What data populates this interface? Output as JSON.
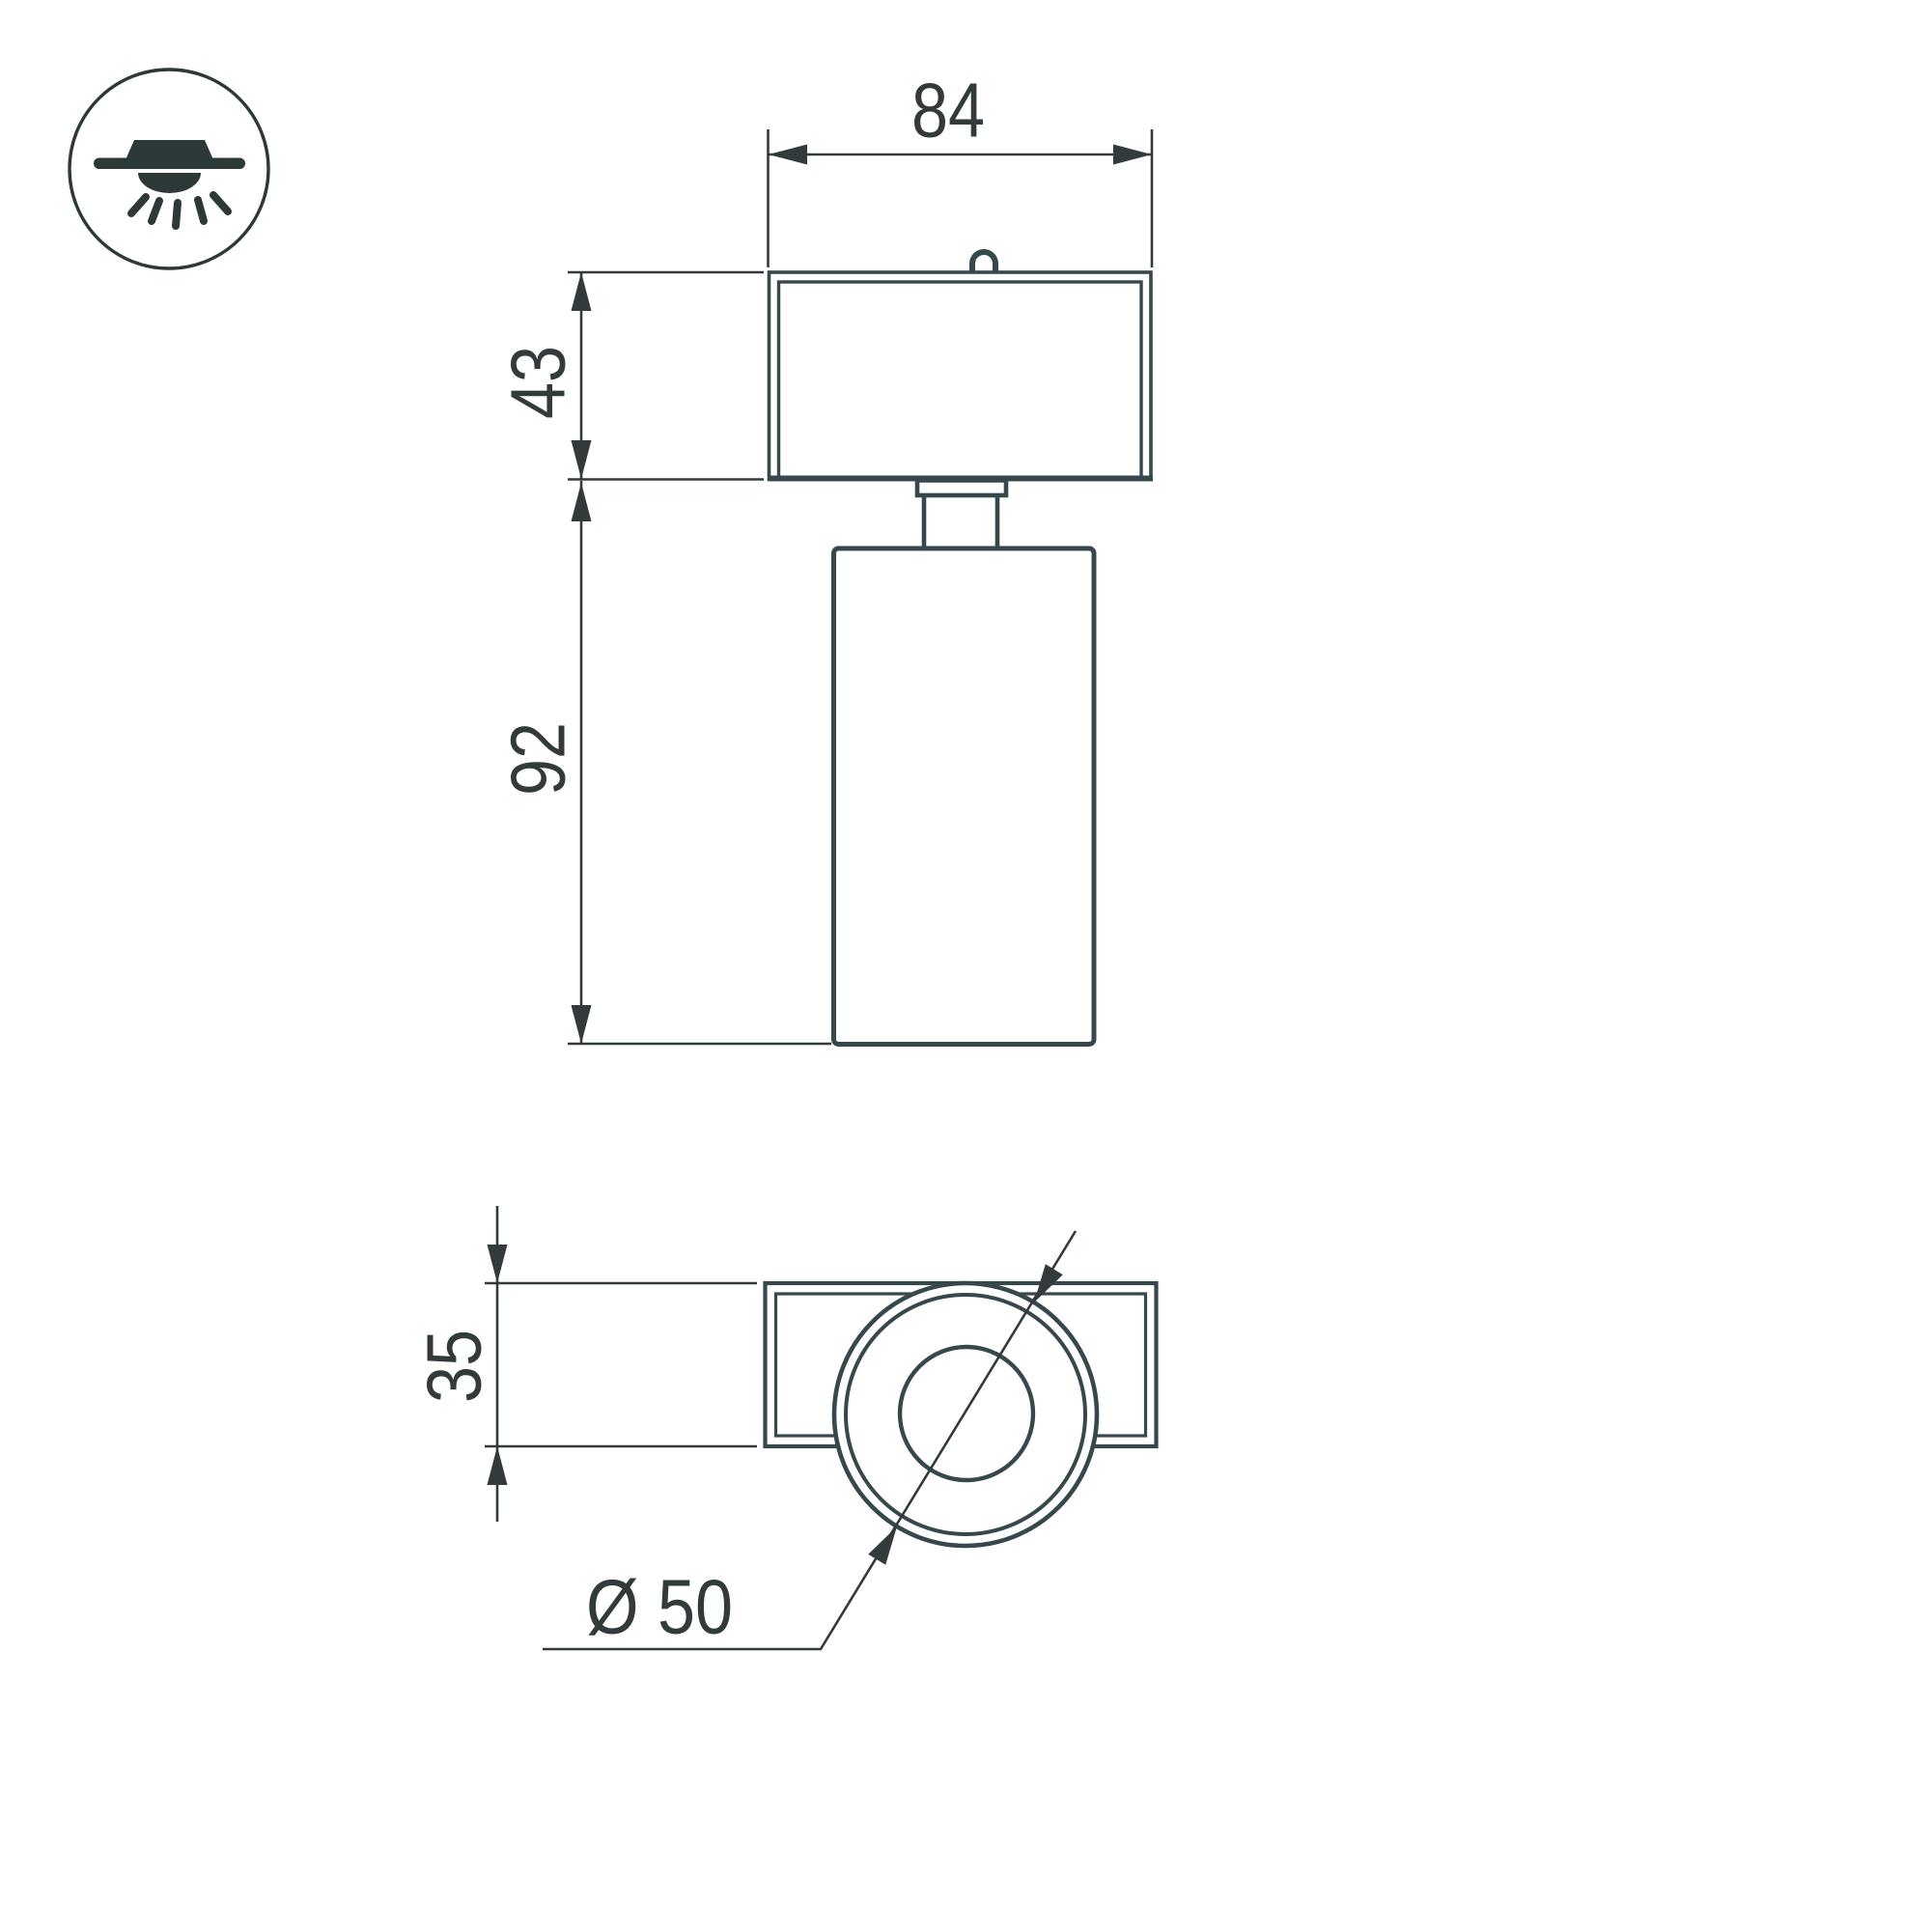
{
  "drawing": {
    "kind": "luminaire-dimension-drawing",
    "views": {
      "front_view": "front projection of spot luminaire",
      "bottom_view": "bottom projection of spot luminaire"
    }
  },
  "icon": {
    "name": "surface-mount-ceiling-light-icon",
    "meaning": "surface mounted downlight with light rays"
  },
  "dimensions": {
    "head_width": "84",
    "head_height": "43",
    "body_height": "92",
    "bracket_depth": "35",
    "body_diameter": "Ø 50"
  },
  "colors": {
    "outline": "#36484b",
    "dimension": "#333a3b",
    "icon": "#2d3839",
    "background": "#ffffff"
  }
}
